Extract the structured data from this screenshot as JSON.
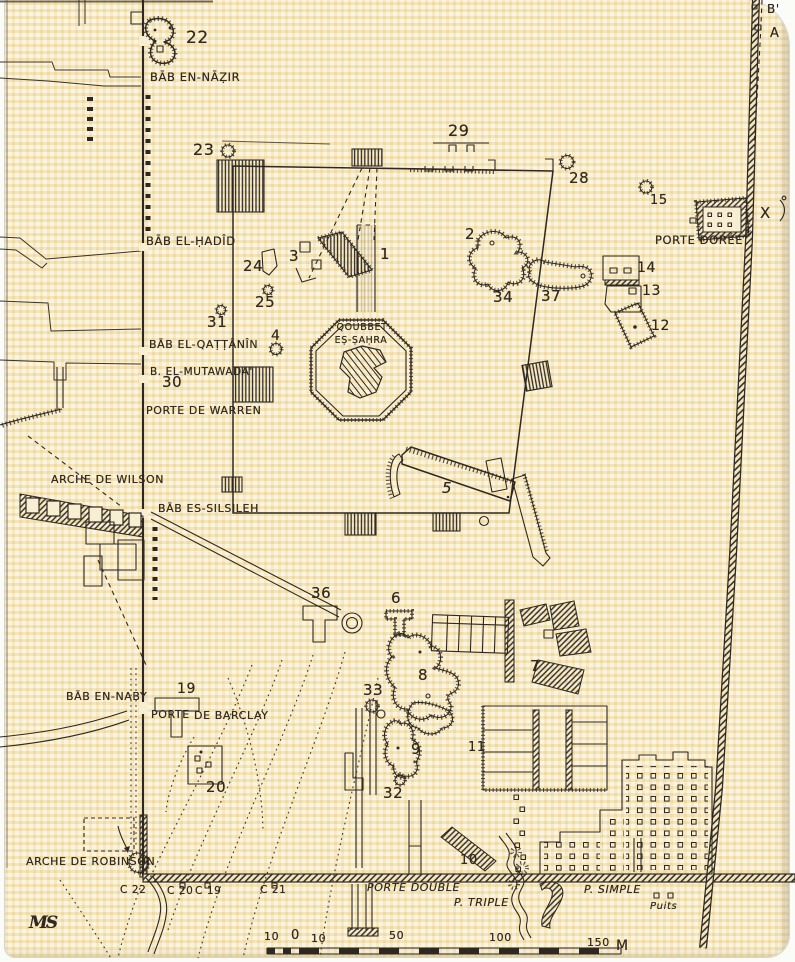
{
  "colors": {
    "paper": "#f8efd3",
    "ink": "#2e2820",
    "check_band": "#f2dfae"
  },
  "map_subject": {
    "central_monument": "QOUBBET EṢ-ṢAḤRA"
  },
  "scale": {
    "unit": "M",
    "tick_values": [
      "10",
      "0",
      "10",
      "50",
      "100",
      "150"
    ]
  },
  "labels": [
    {
      "name": "num-22",
      "text": "22",
      "x": 186,
      "y": 30,
      "fs": 17
    },
    {
      "name": "label-bab-en-nazir",
      "text": "BĀB EN-NĀẒIR",
      "x": 150,
      "y": 72,
      "fs": 11.5
    },
    {
      "name": "num-23",
      "text": "23",
      "x": 193,
      "y": 142,
      "fs": 16
    },
    {
      "name": "num-29",
      "text": "29",
      "x": 448,
      "y": 123,
      "fs": 16
    },
    {
      "name": "num-28",
      "text": "28",
      "x": 569,
      "y": 171,
      "fs": 15
    },
    {
      "name": "num-15",
      "text": "15",
      "x": 650,
      "y": 194,
      "fs": 13
    },
    {
      "name": "label-b-prime",
      "text": "B'",
      "x": 767,
      "y": 3,
      "fs": 12
    },
    {
      "name": "label-a",
      "text": "A",
      "x": 770,
      "y": 27,
      "fs": 13
    },
    {
      "name": "label-porte-doree",
      "text": "PORTE DORÉE",
      "x": 655,
      "y": 235,
      "fs": 11.5
    },
    {
      "name": "label-x",
      "text": "X",
      "x": 760,
      "y": 206,
      "fs": 15
    },
    {
      "name": "label-bab-el-hadid",
      "text": "BĀB EL-ḤADÎD",
      "x": 146,
      "y": 236,
      "fs": 11.5
    },
    {
      "name": "num-24",
      "text": "24",
      "x": 243,
      "y": 259,
      "fs": 15
    },
    {
      "name": "num-3",
      "text": "3",
      "x": 289,
      "y": 249,
      "fs": 15
    },
    {
      "name": "num-1",
      "text": "1",
      "x": 380,
      "y": 247,
      "fs": 15
    },
    {
      "name": "num-2",
      "text": "2",
      "x": 465,
      "y": 227,
      "fs": 15
    },
    {
      "name": "num-34",
      "text": "34",
      "x": 493,
      "y": 290,
      "fs": 15
    },
    {
      "name": "num-37",
      "text": "37",
      "x": 541,
      "y": 289,
      "fs": 15
    },
    {
      "name": "num-14",
      "text": "14",
      "x": 637,
      "y": 261,
      "fs": 14
    },
    {
      "name": "num-13",
      "text": "13",
      "x": 642,
      "y": 284,
      "fs": 14
    },
    {
      "name": "num-12",
      "text": "12",
      "x": 651,
      "y": 319,
      "fs": 14
    },
    {
      "name": "num-25",
      "text": "25",
      "x": 255,
      "y": 295,
      "fs": 15
    },
    {
      "name": "num-31",
      "text": "31",
      "x": 207,
      "y": 315,
      "fs": 15
    },
    {
      "name": "label-bab-el-qattanin",
      "text": "BĀB EL-QAṬṬÂNÎN",
      "x": 149,
      "y": 339,
      "fs": 11
    },
    {
      "name": "num-4",
      "text": "4",
      "x": 271,
      "y": 329,
      "fs": 14
    },
    {
      "name": "label-b-el-mutawada",
      "text": "B. EL-MUTAWADA'",
      "x": 150,
      "y": 367,
      "fs": 10.5
    },
    {
      "name": "num-30",
      "text": "30",
      "x": 162,
      "y": 375,
      "fs": 15
    },
    {
      "name": "label-porte-de-warren",
      "text": "PORTE DE WARREN",
      "x": 146,
      "y": 405,
      "fs": 11
    },
    {
      "name": "label-qoubbet-line1",
      "text": "QOUBBET",
      "x": 362,
      "y": 323,
      "fs": 9.5,
      "c": 1
    },
    {
      "name": "label-qoubbet-line2",
      "text": "EṢ-ṢAḤRA",
      "x": 361,
      "y": 336,
      "fs": 9.5,
      "c": 1
    },
    {
      "name": "label-arche-de-wilson",
      "text": "ARCHE DE WILSON",
      "x": 51,
      "y": 474,
      "fs": 11
    },
    {
      "name": "label-bab-es-silsileh",
      "text": "BĀB ES-SILSILEH",
      "x": 158,
      "y": 503,
      "fs": 11
    },
    {
      "name": "num-5",
      "text": "5",
      "x": 442,
      "y": 481,
      "fs": 15,
      "it": 1
    },
    {
      "name": "num-36",
      "text": "36",
      "x": 311,
      "y": 586,
      "fs": 15
    },
    {
      "name": "num-6",
      "text": "6",
      "x": 391,
      "y": 591,
      "fs": 15
    },
    {
      "name": "num-8",
      "text": "8",
      "x": 418,
      "y": 668,
      "fs": 15
    },
    {
      "name": "num-7",
      "text": "7",
      "x": 530,
      "y": 659,
      "fs": 15
    },
    {
      "name": "num-33",
      "text": "33",
      "x": 363,
      "y": 683,
      "fs": 15
    },
    {
      "name": "label-bab-en-naby",
      "text": "BĀB EN-NABY",
      "x": 66,
      "y": 691,
      "fs": 11
    },
    {
      "name": "num-19",
      "text": "19",
      "x": 177,
      "y": 682,
      "fs": 14
    },
    {
      "name": "label-porte-barclay-1",
      "text": "PORTE",
      "x": 151,
      "y": 709,
      "fs": 11
    },
    {
      "name": "label-porte-barclay-2",
      "text": "DE BARCLAY",
      "x": 194,
      "y": 710,
      "fs": 11
    },
    {
      "name": "num-20",
      "text": "20",
      "x": 206,
      "y": 780,
      "fs": 15
    },
    {
      "name": "num-9",
      "text": "9",
      "x": 411,
      "y": 742,
      "fs": 15
    },
    {
      "name": "num-32",
      "text": "32",
      "x": 383,
      "y": 786,
      "fs": 15
    },
    {
      "name": "num-11",
      "text": "11",
      "x": 468,
      "y": 741,
      "fs": 13
    },
    {
      "name": "num-10",
      "text": "10",
      "x": 460,
      "y": 854,
      "fs": 13
    },
    {
      "name": "label-arche-de-robinson",
      "text": "ARCHE DE ROBINSON",
      "x": 26,
      "y": 856,
      "fs": 11
    },
    {
      "name": "ref-c22",
      "text": "C 22",
      "x": 120,
      "y": 885,
      "fs": 10.5
    },
    {
      "name": "ref-c20",
      "text": "C 20",
      "x": 167,
      "y": 886,
      "fs": 10.5
    },
    {
      "name": "ref-c19",
      "text": "C 19",
      "x": 195,
      "y": 886,
      "fs": 10.5
    },
    {
      "name": "ref-c21",
      "text": "C 21",
      "x": 260,
      "y": 885,
      "fs": 10.5
    },
    {
      "name": "label-porte-double",
      "text": "PORTE DOUBLE",
      "x": 367,
      "y": 882,
      "fs": 11,
      "it": 1
    },
    {
      "name": "label-p-triple",
      "text": "P. TRIPLE",
      "x": 454,
      "y": 897,
      "fs": 11,
      "it": 1
    },
    {
      "name": "label-p-simple",
      "text": "P. SIMPLE",
      "x": 584,
      "y": 884,
      "fs": 11,
      "it": 1
    },
    {
      "name": "label-puits",
      "text": "Puits",
      "x": 650,
      "y": 902,
      "fs": 10,
      "it": 1
    },
    {
      "name": "cartographer-monogram",
      "text": "MS",
      "x": 29,
      "y": 915,
      "fs": 17,
      "serif": 1
    },
    {
      "name": "scale-tick-10-left",
      "text": "10",
      "x": 264,
      "y": 931,
      "fs": 11
    },
    {
      "name": "scale-tick-0",
      "text": "0",
      "x": 291,
      "y": 929,
      "fs": 13
    },
    {
      "name": "scale-tick-10-right",
      "text": "10",
      "x": 311,
      "y": 933,
      "fs": 11
    },
    {
      "name": "scale-tick-50",
      "text": "50",
      "x": 389,
      "y": 930,
      "fs": 11
    },
    {
      "name": "scale-tick-100",
      "text": "100",
      "x": 489,
      "y": 932,
      "fs": 11
    },
    {
      "name": "scale-tick-150",
      "text": "150",
      "x": 587,
      "y": 937,
      "fs": 11
    },
    {
      "name": "scale-unit",
      "text": "M",
      "x": 616,
      "y": 939,
      "fs": 14
    }
  ]
}
